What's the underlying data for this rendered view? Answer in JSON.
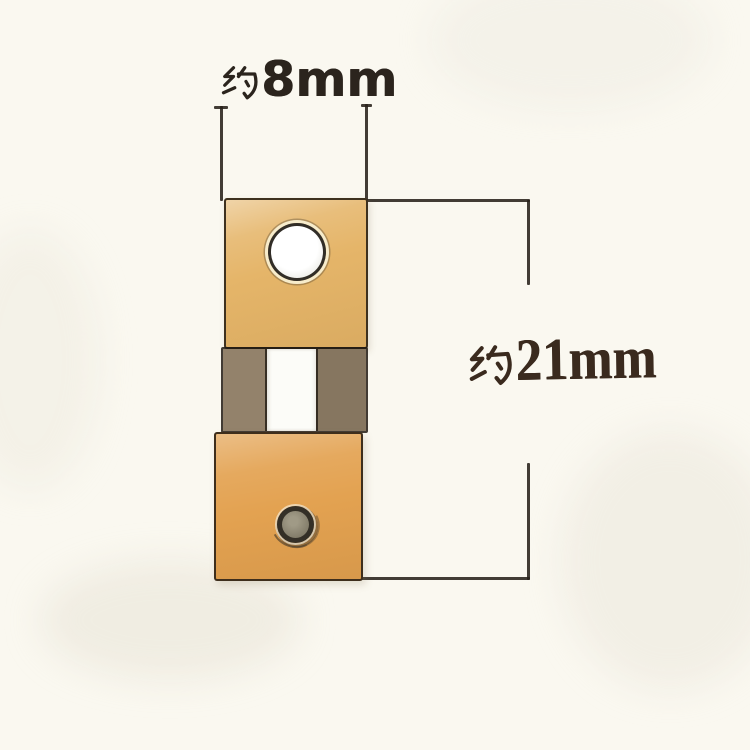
{
  "image": {
    "kind": "product dimension photo",
    "subject": "brass clock suspension spring part",
    "background_color": "#faf8f0"
  },
  "dimensions": {
    "width": {
      "label": "约8mm",
      "prefix": "约",
      "value": "8mm"
    },
    "height": {
      "label": "约21mm",
      "prefix": "约",
      "value": "21mm"
    },
    "line_color": "rgba(40,33,26,0.88)",
    "width_label_color": "#2b241d",
    "height_label_color": "#3a2a1e"
  },
  "part": {
    "top_block_color": "#e5b569",
    "top_block_color_light": "#f0d18c",
    "middle_left_block_color": "#93826b",
    "middle_right_block_color": "#867660",
    "spring_strip_color": "#fcfcf8",
    "bottom_block_color": "#e3a251",
    "bottom_block_color_light": "#edb866",
    "outline_color": "#211a13",
    "hole_fill_color": "#ffffff",
    "hole_ring_color": "#1c1711",
    "rivet_core_color": "#8c8673",
    "rivet_ring_color": "#2c2821"
  }
}
